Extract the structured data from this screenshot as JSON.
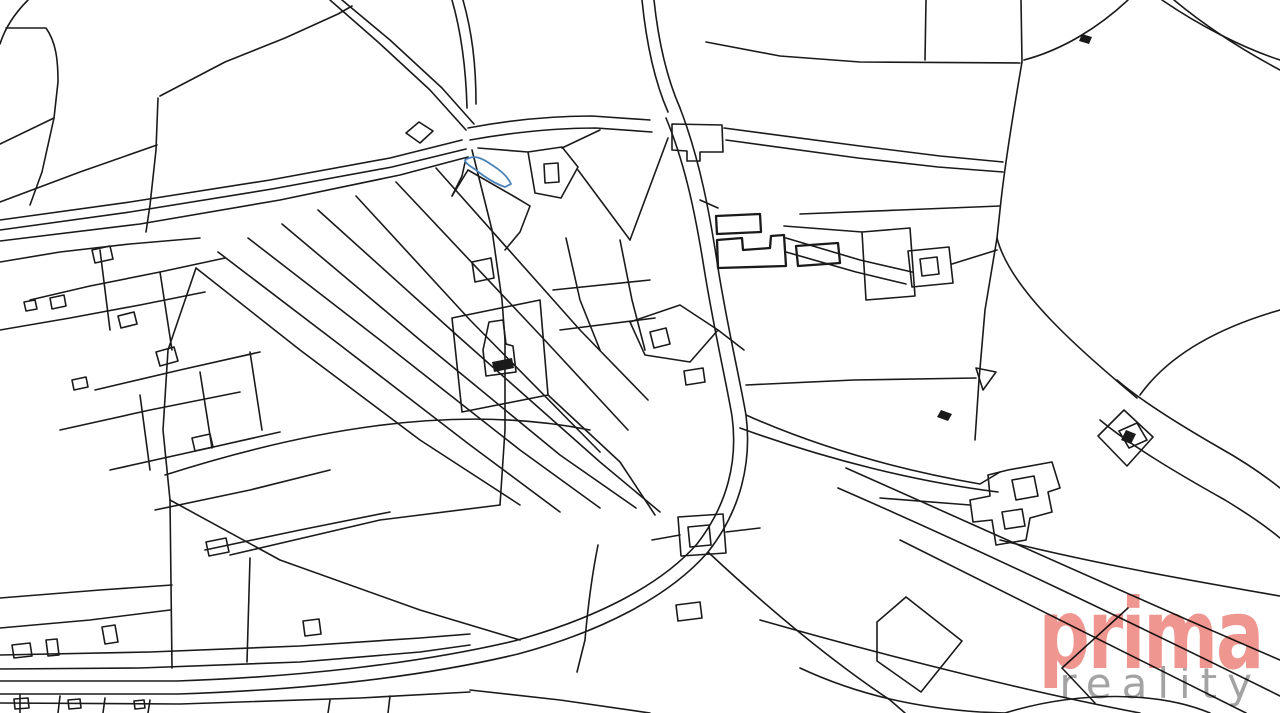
{
  "map": {
    "type": "cadastral parcel map",
    "background_color": "#ffffff",
    "line_color": "#1a1a1a",
    "highlighted_parcel": {
      "description": "narrow sliver parcel highlighted in blue near top center",
      "fill": "#b9d7ef",
      "stroke": "#4b82b8"
    }
  },
  "watermark": {
    "brand": "prima",
    "brand_color": "#ee8d86",
    "subtitle": "reality",
    "subtitle_color": "#9b9b9b"
  }
}
